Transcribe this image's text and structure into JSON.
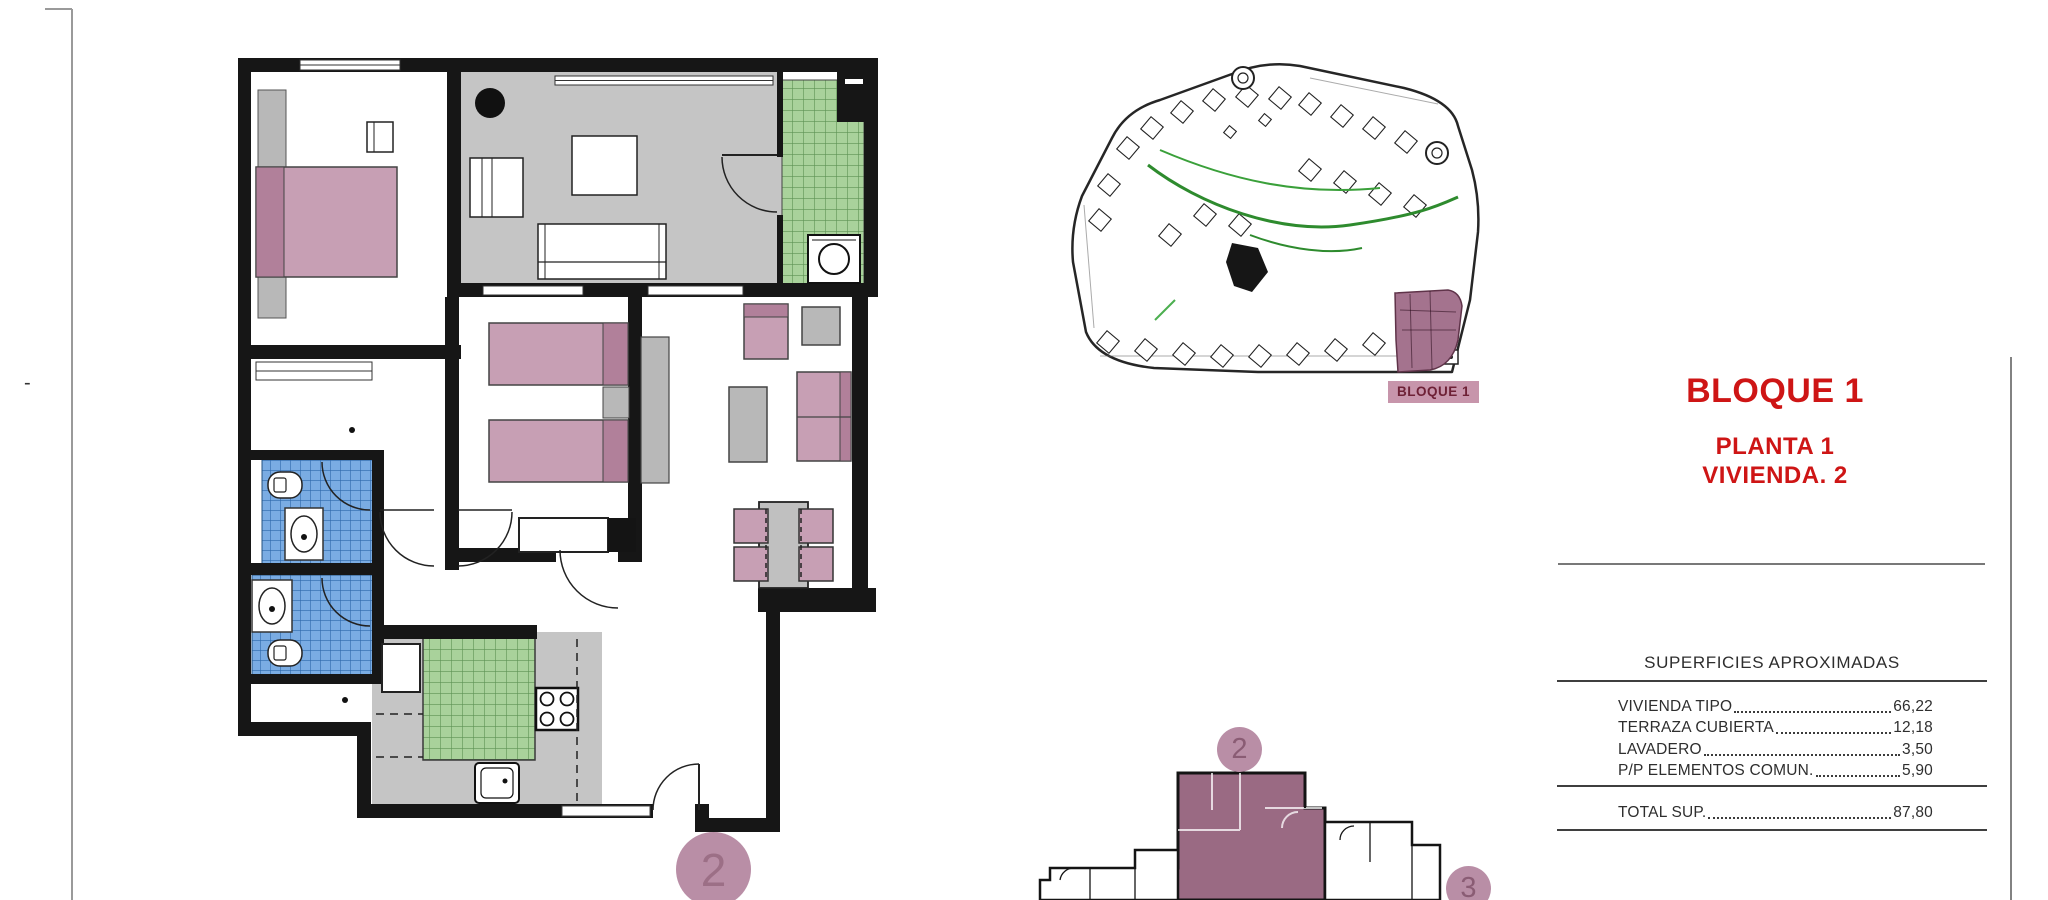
{
  "page": {
    "dash": "-"
  },
  "right_panel": {
    "block_title": "BLOQUE 1",
    "floor_label": "PLANTA 1",
    "unit_label": "VIVIENDA. 2"
  },
  "areas_table": {
    "title": "SUPERFICIES APROXIMADAS",
    "rows": [
      {
        "label": "VIVIENDA TIPO",
        "value": "66,22"
      },
      {
        "label": "TERRAZA CUBIERTA",
        "value": "12,18"
      },
      {
        "label": "LAVADERO",
        "value": "3,50"
      },
      {
        "label": "P/P ELEMENTOS COMUN.",
        "value": "5,90"
      }
    ],
    "total": {
      "label": "TOTAL SUP.",
      "value": "87,80"
    }
  },
  "site_plan": {
    "label": "BLOQUE 1"
  },
  "unit_marker": "2",
  "key_plan": {
    "unit_markers": [
      "2",
      "3"
    ]
  },
  "colors": {
    "accent_red": "#ce1515",
    "wall_black": "#161616",
    "floor_gray": "#c5c5c5",
    "furniture_pink": "#c79fb4",
    "furniture_pink_dark": "#b1809a",
    "tile_green": "#a9d29b",
    "tile_blue": "#7aace3",
    "marker_mauve": "#b98ea6",
    "site_highlight": "#a4738e",
    "label_bg": "#c795ab"
  }
}
